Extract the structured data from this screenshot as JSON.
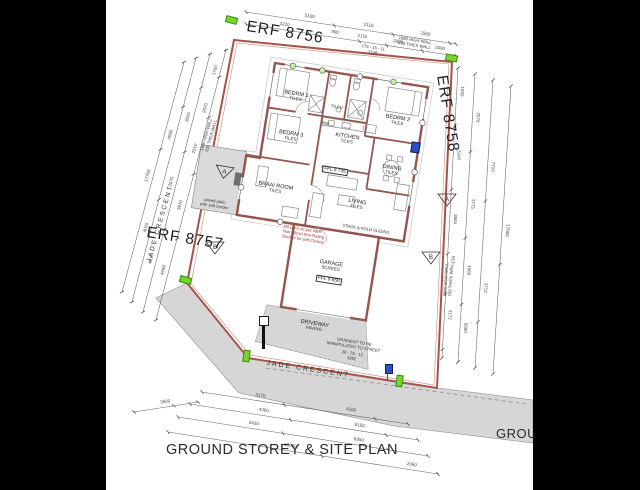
{
  "title": {
    "main": "GROUND STOREY & SITE PLAN",
    "partial_right": "GROU"
  },
  "erf": {
    "top": "ERF 8756",
    "left": "ERF 8757",
    "right": "ERF 8758"
  },
  "streets": {
    "bottom": "JADE CRESCENT",
    "left": "JADE CRESCENT"
  },
  "rooms": [
    {
      "name": "BEDRM 1",
      "sub": "TILES"
    },
    {
      "name": "BEDRM 2",
      "sub": "TILES"
    },
    {
      "name": "BEDRM 3",
      "sub": "TILES"
    },
    {
      "name": "KITCHEN",
      "sub": "TILES"
    },
    {
      "name": "DINING",
      "sub": "TILES"
    },
    {
      "name": "LIVING",
      "sub": "TILES"
    },
    {
      "name": "BRAAI ROOM",
      "sub": "TILES"
    },
    {
      "name": "GARAGE",
      "sub": "SCREED"
    },
    {
      "name": "DRIVEWAY",
      "sub": "PAVING"
    },
    {
      "name": "BATH",
      "sub": "TILED"
    }
  ],
  "ffl": {
    "main": "FFL 9 735",
    "garage": "FFL 9 650"
  },
  "markers": {
    "a": "A",
    "b": "B"
  },
  "notes": {
    "boundary_wall": {
      "l1": "1800 HIGH WALL",
      "l2": "230 THICK WALL"
    },
    "gradient": {
      "l1": "GRADIENT TO BE",
      "l2": "MANIPULATED TO STREET"
    },
    "fire": {
      "l1": "FR Door as per NBR",
      "l2": "Non 60min Fire Rating",
      "l3": "Door to be self Closing"
    },
    "stack": "STACK & FOLD SLIDING",
    "patio": {
      "l1": "paved patio",
      "l2": "with soft border"
    },
    "passage_dim": "900",
    "bearing_top": {
      "l1": "175 - 15 - 11",
      "l2": "1740"
    },
    "bearing_bottom": {
      "l1": "28 - 78 - 12",
      "l2": "1982"
    }
  },
  "colors": {
    "wall": "#96544e",
    "boundary": "#a8524a",
    "road_fill": "#d6d6d6",
    "peg_green": "#76d62c",
    "marker_blue": "#2a52c8"
  },
  "dim_chains": [
    {
      "x1": 50,
      "y1": 320,
      "x2": 120,
      "y2": 50,
      "labels": [
        {
          "t": "4060",
          "f": 0.18
        },
        {
          "t": "3970",
          "f": 0.42
        },
        {
          "t": "2510",
          "f": 0.63
        },
        {
          "t": "2570",
          "f": 0.78
        },
        {
          "t": "1700",
          "f": 0.92
        }
      ]
    },
    {
      "x1": 37,
      "y1": 312,
      "x2": 104,
      "y2": 54,
      "labels": [
        {
          "t": "4515",
          "f": 0.2
        },
        {
          "t": "2570",
          "f": 0.5
        },
        {
          "t": "3500",
          "f": 0.75
        }
      ]
    },
    {
      "x1": 26,
      "y1": 302,
      "x2": 90,
      "y2": 58,
      "labels": [
        {
          "t": "4015",
          "f": 0.3
        },
        {
          "t": "4060",
          "f": 0.68
        }
      ]
    },
    {
      "x1": 16,
      "y1": 292,
      "x2": 78,
      "y2": 62,
      "labels": [
        {
          "t": "17765",
          "f": 0.5
        }
      ]
    },
    {
      "x1": 140,
      "y1": 12,
      "x2": 350,
      "y2": 44,
      "labels": [
        {
          "t": "5100",
          "f": 0.3
        },
        {
          "t": "2110",
          "f": 0.58
        },
        {
          "t": "2560",
          "f": 0.85
        }
      ]
    },
    {
      "x1": 140,
      "y1": 24,
      "x2": 350,
      "y2": 56,
      "labels": [
        {
          "t": "3220",
          "f": 0.18
        },
        {
          "t": "900",
          "f": 0.42
        },
        {
          "t": "2110",
          "f": 0.55
        },
        {
          "t": "2900",
          "f": 0.72
        },
        {
          "t": "2000",
          "f": 0.92
        }
      ]
    },
    {
      "x1": 352,
      "y1": 68,
      "x2": 336,
      "y2": 358,
      "labels": [
        {
          "t": "1950",
          "f": 0.08
        },
        {
          "t": "5147",
          "f": 0.3
        },
        {
          "t": "3664",
          "f": 0.52
        },
        {
          "t": "913",
          "f": 0.66
        },
        {
          "t": "3172",
          "f": 0.85
        }
      ]
    },
    {
      "x1": 369,
      "y1": 74,
      "x2": 352,
      "y2": 362,
      "labels": [
        {
          "t": "2570",
          "f": 0.15
        },
        {
          "t": "3775",
          "f": 0.45
        },
        {
          "t": "1980",
          "f": 0.68
        },
        {
          "t": "5880",
          "f": 0.88
        }
      ]
    },
    {
      "x1": 387,
      "y1": 80,
      "x2": 369,
      "y2": 368,
      "labels": [
        {
          "t": "7710",
          "f": 0.3
        },
        {
          "t": "3772",
          "f": 0.72
        }
      ]
    },
    {
      "x1": 405,
      "y1": 86,
      "x2": 387,
      "y2": 374,
      "labels": [
        {
          "t": "17060",
          "f": 0.5
        }
      ]
    },
    {
      "x1": 96,
      "y1": 392,
      "x2": 302,
      "y2": 424,
      "labels": [
        {
          "t": "3170",
          "f": 0.28
        },
        {
          "t": "4200",
          "f": 0.72
        }
      ]
    },
    {
      "x1": 84,
      "y1": 404,
      "x2": 312,
      "y2": 440,
      "labels": [
        {
          "t": "4360",
          "f": 0.32
        },
        {
          "t": "5150",
          "f": 0.74
        }
      ]
    },
    {
      "x1": 72,
      "y1": 417,
      "x2": 322,
      "y2": 456,
      "labels": [
        {
          "t": "3430",
          "f": 0.3
        },
        {
          "t": "6950",
          "f": 0.72
        }
      ]
    },
    {
      "x1": 28,
      "y1": 412,
      "x2": 92,
      "y2": 402,
      "labels": [
        {
          "t": "3650",
          "f": 0.5
        }
      ]
    },
    {
      "x1": 62,
      "y1": 432,
      "x2": 332,
      "y2": 474,
      "labels": [
        {
          "t": "10060",
          "f": 0.45
        },
        {
          "t": "2060",
          "f": 0.9
        }
      ]
    }
  ]
}
